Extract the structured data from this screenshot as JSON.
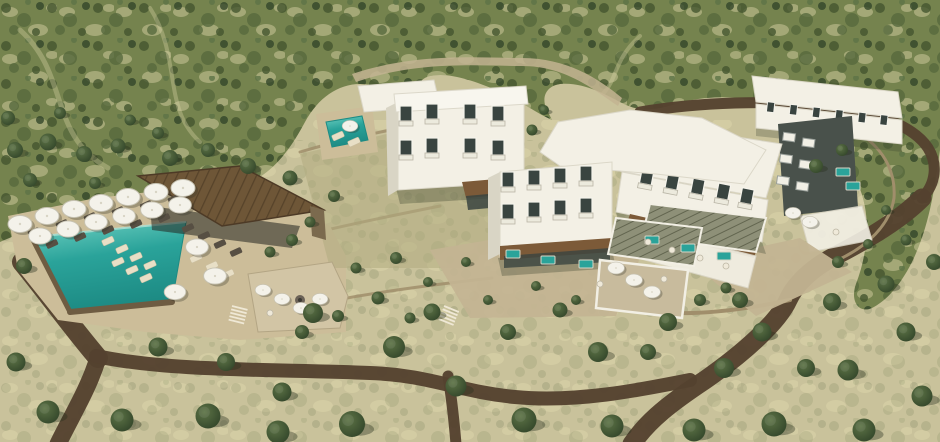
{
  "scene": {
    "description": "Aerial 3D architectural rendering of a hillside resort hotel: white cubic guest buildings with balconies, a teal swimming pool with white parasols and sun loungers, a flat brown-roofed pool bar pavilion, sage pergola roofs, stone terraces and retaining walls, dark earth roads winding through olive-dotted scrubland",
    "elements": [
      "scrub hillside",
      "swimming pool",
      "pool bar pavilion",
      "sun umbrellas",
      "sun loungers",
      "guest wing",
      "main building",
      "east wing",
      "back block",
      "dark annex",
      "pergola roofs",
      "stone terraces",
      "earth roads",
      "olive trees",
      "plunge pools",
      "fire pit lounge"
    ]
  },
  "palette": {
    "scrub_base": "#c9c29b",
    "scrub_hill": "#75834e",
    "shrub_dark": "#44552f",
    "shrub_mid": "#57693d",
    "patch_cream": "#ddd6aa",
    "road_brown": "#54422f",
    "stone_path": "#c3b492",
    "deck_tan": "#ccbd99",
    "wall_tan": "#a08e6b",
    "wall_dark": "#6e5c42",
    "building_white": "#f3f0e5",
    "building_shade": "#d9d5c5",
    "window_dark": "#394440",
    "roof_brown": "#6e5637",
    "awning_brown": "#7c5a38",
    "pergola_sage": "#8e9078",
    "pool_teal": "#2aa39a",
    "pool_deep": "#1d8b84",
    "pool_light": "#6fd0c2",
    "umbrella_white": "#f4f2ea",
    "tree_green": "#5d7346",
    "tree_dark": "#33462a",
    "shadow_olive": "#2e3826",
    "charcoal": "#49514b",
    "terrace_wood": "#c8bb9d"
  },
  "scene_points": {
    "trees": [
      [
        15,
        150,
        0.8
      ],
      [
        48,
        142,
        0.85
      ],
      [
        84,
        154,
        0.8
      ],
      [
        118,
        146,
        0.75
      ],
      [
        30,
        180,
        0.7
      ],
      [
        95,
        183,
        0.6
      ],
      [
        8,
        118,
        0.7
      ],
      [
        60,
        113,
        0.6
      ],
      [
        130,
        120,
        0.55
      ],
      [
        158,
        133,
        0.6
      ],
      [
        170,
        158,
        0.8
      ],
      [
        208,
        150,
        0.7
      ],
      [
        248,
        166,
        0.8
      ],
      [
        290,
        178,
        0.75
      ],
      [
        313,
        313,
        1.0
      ],
      [
        394,
        347,
        1.1
      ],
      [
        352,
        424,
        1.3
      ],
      [
        282,
        392,
        0.95
      ],
      [
        226,
        362,
        0.9
      ],
      [
        158,
        347,
        0.95
      ],
      [
        24,
        266,
        0.8
      ],
      [
        16,
        362,
        0.95
      ],
      [
        48,
        412,
        1.15
      ],
      [
        122,
        420,
        1.15
      ],
      [
        208,
        416,
        1.25
      ],
      [
        278,
        432,
        1.15
      ],
      [
        432,
        312,
        0.85
      ],
      [
        456,
        386,
        1.05
      ],
      [
        508,
        332,
        0.8
      ],
      [
        524,
        420,
        1.25
      ],
      [
        598,
        352,
        1.0
      ],
      [
        612,
        426,
        1.15
      ],
      [
        668,
        322,
        0.9
      ],
      [
        694,
        430,
        1.15
      ],
      [
        724,
        368,
        1.0
      ],
      [
        762,
        332,
        0.95
      ],
      [
        774,
        424,
        1.25
      ],
      [
        832,
        302,
        0.9
      ],
      [
        848,
        370,
        1.05
      ],
      [
        864,
        430,
        1.15
      ],
      [
        906,
        332,
        0.95
      ],
      [
        922,
        396,
        1.05
      ],
      [
        934,
        262,
        0.8
      ],
      [
        886,
        284,
        0.85
      ],
      [
        560,
        310,
        0.75
      ],
      [
        648,
        352,
        0.8
      ],
      [
        740,
        300,
        0.8
      ],
      [
        806,
        368,
        0.9
      ],
      [
        816,
        166,
        0.7
      ],
      [
        842,
        150,
        0.6
      ]
    ],
    "bushes": [
      [
        356,
        268,
        0.55
      ],
      [
        396,
        258,
        0.6
      ],
      [
        378,
        298,
        0.65
      ],
      [
        428,
        282,
        0.5
      ],
      [
        466,
        262,
        0.5
      ],
      [
        302,
        332,
        0.7
      ],
      [
        338,
        316,
        0.6
      ],
      [
        410,
        318,
        0.55
      ],
      [
        488,
        300,
        0.5
      ],
      [
        536,
        286,
        0.5
      ],
      [
        576,
        300,
        0.5
      ],
      [
        700,
        300,
        0.6
      ],
      [
        726,
        288,
        0.55
      ],
      [
        838,
        262,
        0.6
      ],
      [
        868,
        244,
        0.5
      ],
      [
        886,
        210,
        0.5
      ],
      [
        906,
        240,
        0.55
      ],
      [
        334,
        196,
        0.6
      ],
      [
        310,
        222,
        0.55
      ],
      [
        292,
        240,
        0.6
      ],
      [
        270,
        252,
        0.55
      ],
      [
        532,
        130,
        0.55
      ],
      [
        544,
        110,
        0.5
      ]
    ],
    "umbrellas": [
      [
        20,
        224,
        1
      ],
      [
        47,
        216,
        1
      ],
      [
        74,
        209,
        1
      ],
      [
        101,
        203,
        1
      ],
      [
        128,
        197,
        1
      ],
      [
        156,
        192,
        1
      ],
      [
        183,
        188,
        1
      ],
      [
        40,
        236,
        0.95
      ],
      [
        68,
        229,
        0.95
      ],
      [
        96,
        222,
        0.95
      ],
      [
        124,
        216,
        0.95
      ],
      [
        152,
        210,
        0.95
      ],
      [
        180,
        205,
        0.95
      ],
      [
        197,
        247,
        0.95
      ],
      [
        215,
        276,
        0.95
      ],
      [
        175,
        292,
        0.9
      ],
      [
        263,
        290,
        0.65
      ],
      [
        282,
        299,
        0.65
      ],
      [
        301,
        308,
        0.65
      ],
      [
        320,
        299,
        0.65
      ],
      [
        616,
        268,
        0.7
      ],
      [
        634,
        280,
        0.7
      ],
      [
        652,
        292,
        0.7
      ],
      [
        793,
        213,
        0.65
      ],
      [
        810,
        222,
        0.65
      ],
      [
        350,
        126,
        0.65
      ]
    ],
    "loungers_dark": [
      [
        34,
        232
      ],
      [
        62,
        224
      ],
      [
        90,
        217
      ],
      [
        118,
        211
      ],
      [
        146,
        205
      ],
      [
        174,
        199
      ],
      [
        52,
        244
      ],
      [
        80,
        237
      ],
      [
        108,
        230
      ],
      [
        136,
        224
      ],
      [
        164,
        218
      ],
      [
        188,
        228
      ],
      [
        204,
        236
      ],
      [
        220,
        244
      ],
      [
        236,
        252
      ]
    ],
    "loungers_light": [
      [
        108,
        241
      ],
      [
        122,
        249
      ],
      [
        136,
        257
      ],
      [
        150,
        265
      ],
      [
        118,
        262
      ],
      [
        132,
        270
      ],
      [
        146,
        278
      ],
      [
        196,
        258
      ],
      [
        212,
        266
      ],
      [
        228,
        274
      ],
      [
        338,
        136
      ],
      [
        354,
        142
      ]
    ],
    "tables": [
      [
        600,
        284
      ],
      [
        664,
        279
      ],
      [
        270,
        313
      ],
      [
        836,
        232
      ],
      [
        648,
        242
      ],
      [
        672,
        250
      ],
      [
        700,
        258
      ],
      [
        726,
        266
      ]
    ],
    "plunge_pools": [
      [
        513,
        254
      ],
      [
        548,
        260
      ],
      [
        586,
        264
      ],
      [
        652,
        240
      ],
      [
        688,
        248
      ],
      [
        724,
        256
      ],
      [
        843,
        172
      ],
      [
        853,
        186
      ]
    ],
    "windows_ab": [
      [
        406,
        114
      ],
      [
        432,
        112
      ],
      [
        470,
        112
      ],
      [
        498,
        114
      ],
      [
        406,
        148
      ],
      [
        432,
        146
      ],
      [
        470,
        146
      ],
      [
        498,
        148
      ]
    ],
    "windows_c": [
      [
        508,
        180
      ],
      [
        534,
        178
      ],
      [
        560,
        176
      ],
      [
        586,
        174
      ],
      [
        508,
        212
      ],
      [
        534,
        210
      ],
      [
        560,
        208
      ],
      [
        586,
        206
      ]
    ],
    "windows_d": [
      [
        646,
        176
      ],
      [
        672,
        176
      ],
      [
        698,
        176
      ],
      [
        724,
        176
      ],
      [
        748,
        176
      ]
    ],
    "windows_e": [
      [
        770,
        106,
        0.72
      ],
      [
        793,
        106,
        0.72
      ],
      [
        816,
        106,
        0.72
      ],
      [
        839,
        106,
        0.72
      ],
      [
        862,
        106,
        0.72
      ],
      [
        884,
        106,
        0.72
      ]
    ],
    "balconies": [
      [
        790,
        136
      ],
      [
        810,
        139
      ],
      [
        790,
        158
      ],
      [
        810,
        161
      ],
      [
        790,
        180
      ],
      [
        810,
        183
      ]
    ]
  }
}
